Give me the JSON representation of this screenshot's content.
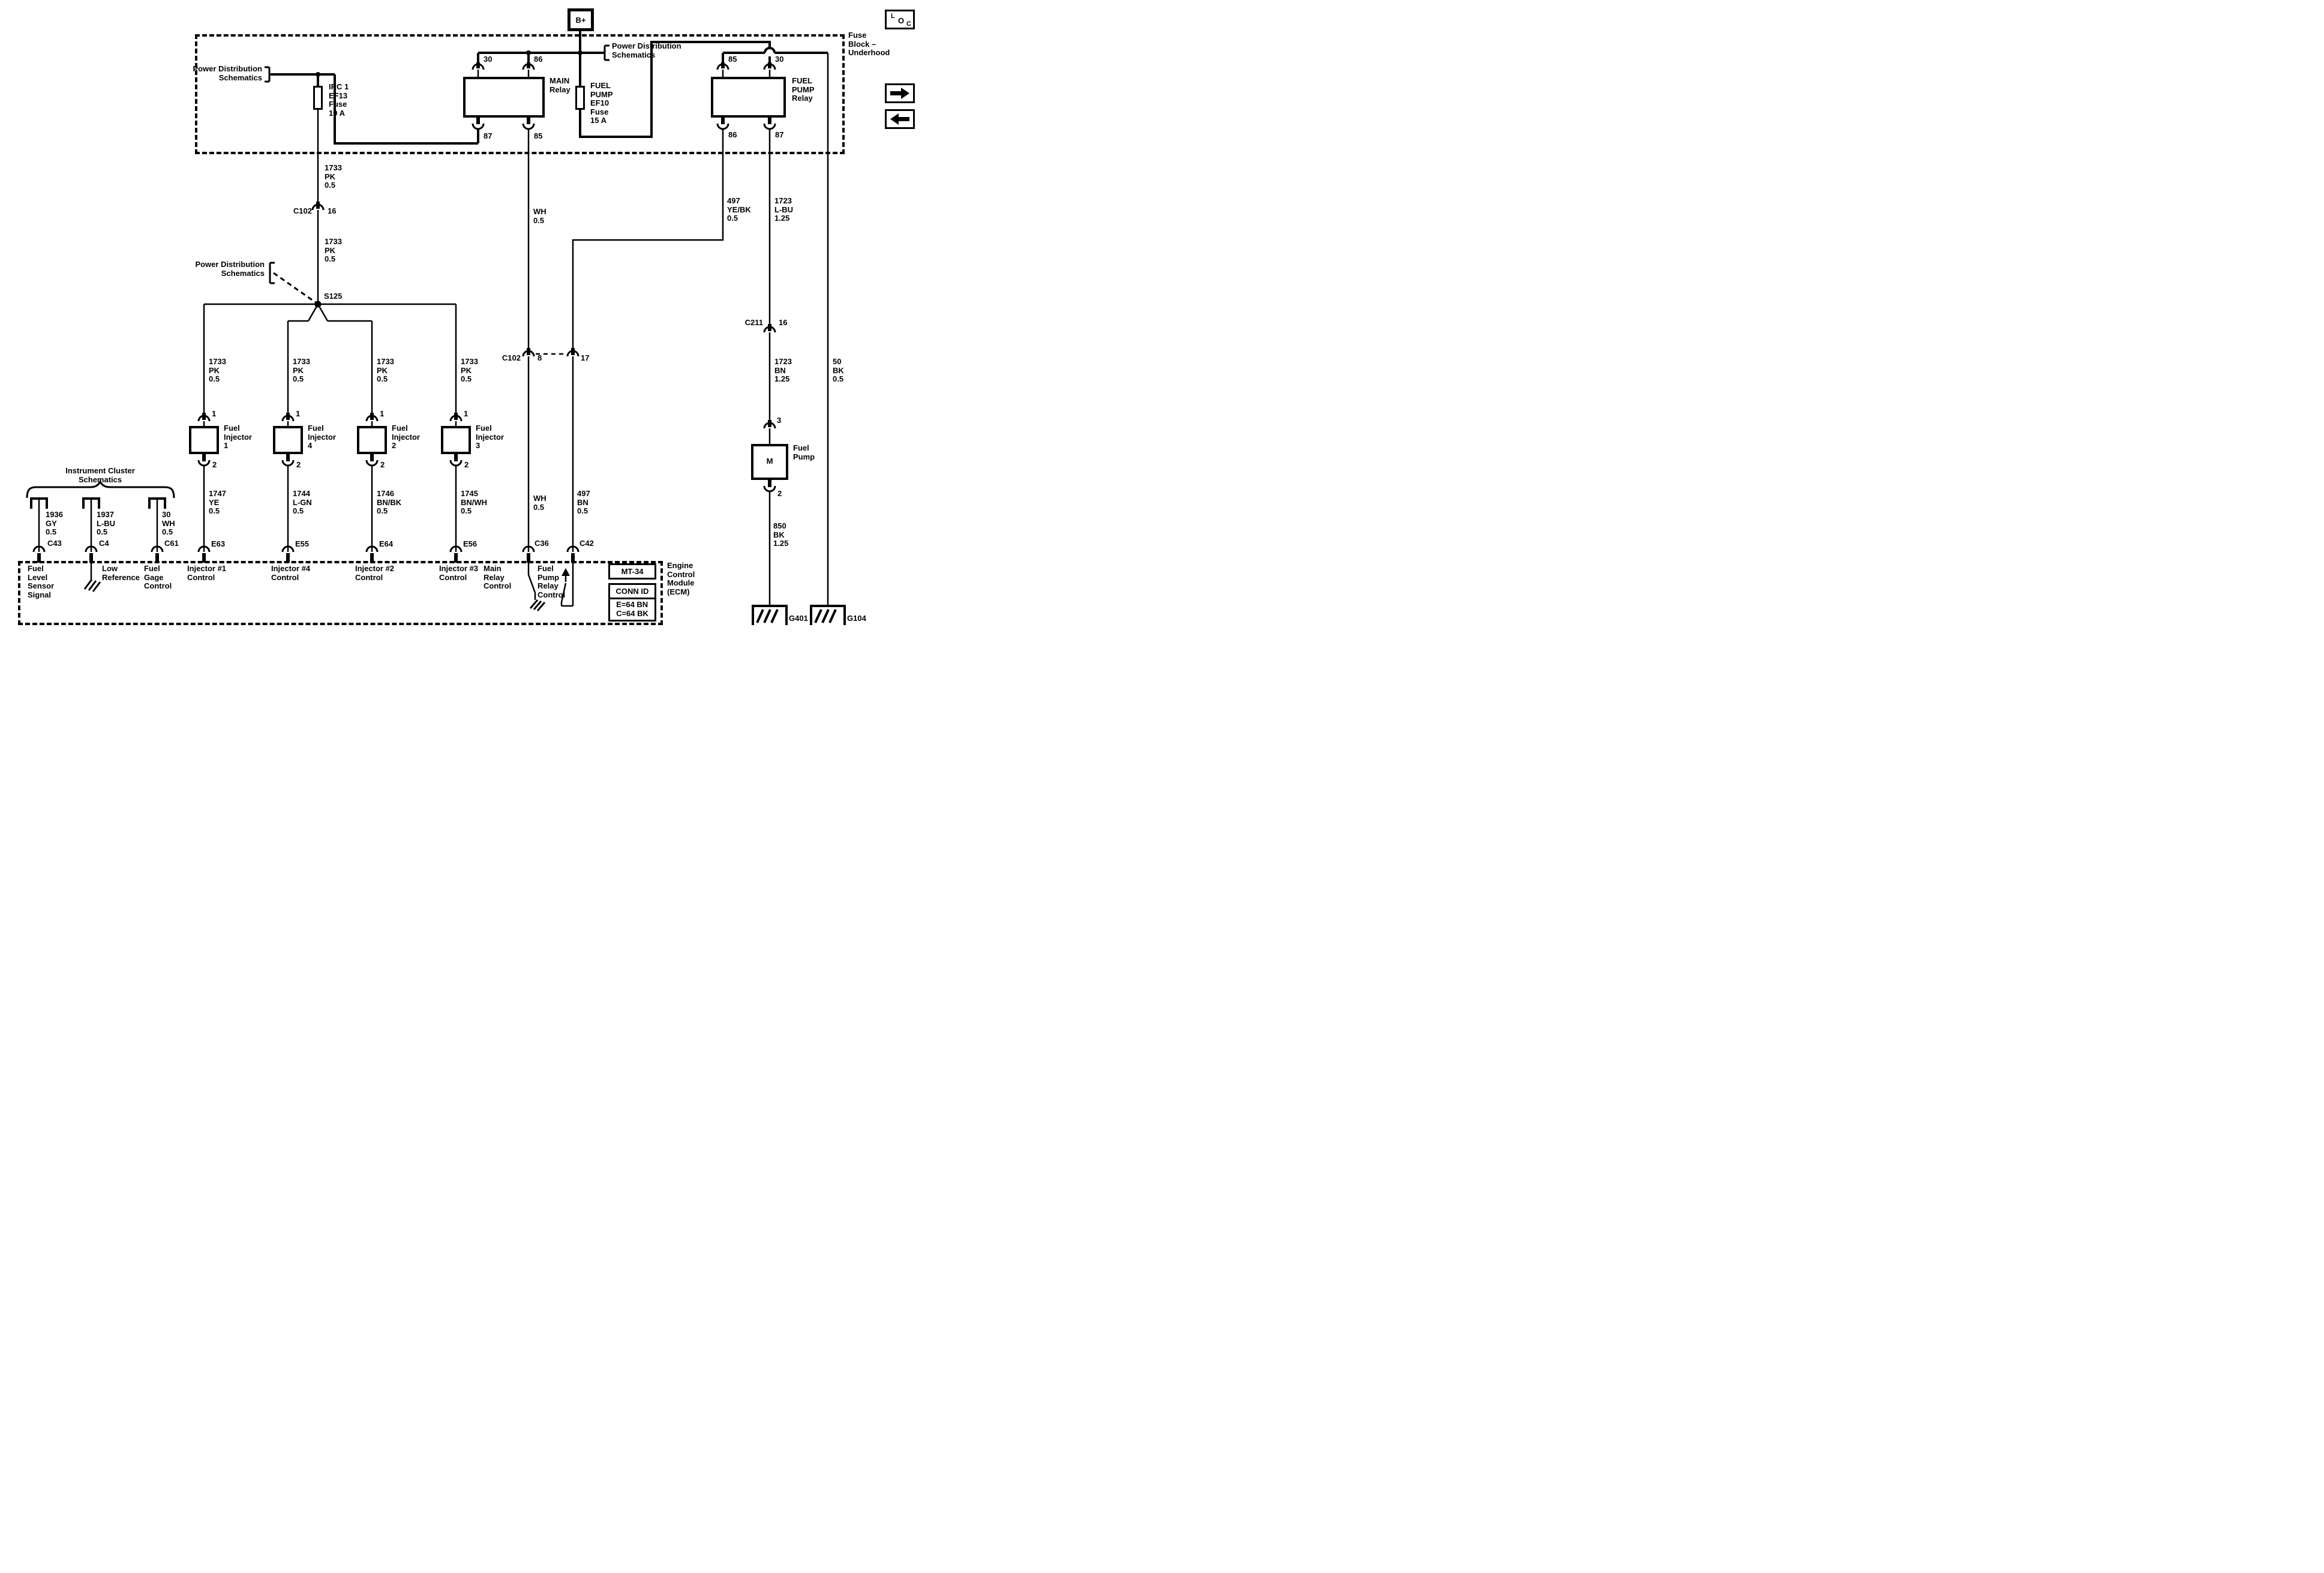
{
  "viewer": {
    "loc": {
      "l": "L",
      "o": "O",
      "c": "C"
    },
    "next_label": "next-page",
    "prev_label": "previous-page"
  },
  "fuse_block": {
    "label": "Fuse\nBlock –\nUnderhood",
    "bplus": "B+",
    "pds_top": "Power Distribution\nSchematics",
    "pds_left": "Power Distribution\nSchematics",
    "ef13_fuse": "IRC 1\nEF13\nFuse\n10 A",
    "ef10_fuse": "FUEL\nPUMP\nEF10\nFuse\n15 A",
    "main_relay": {
      "label": "MAIN\nRelay",
      "pin_30": "30",
      "pin_86": "86",
      "pin_87": "87",
      "pin_85": "85"
    },
    "fuel_pump_relay": {
      "label": "FUEL\nPUMP\nRelay",
      "pin_85": "85",
      "pin_30": "30",
      "pin_86": "86",
      "pin_87": "87"
    }
  },
  "pds_s125": "Power Distribution\nSchematics",
  "splice": "S125",
  "c102_16": {
    "name": "C102",
    "pin": "16",
    "wire_above": "1733\nPK\n0.5",
    "wire_below": "1733\nPK\n0.5"
  },
  "injectors": [
    {
      "wire_top": "1733\nPK\n0.5",
      "pin_top": "1",
      "label": "Fuel\nInjector\n1",
      "pin_bottom": "2",
      "wire_bottom": "1747\nYE\n0.5",
      "connector": "E63",
      "control": "Injector #1\nControl"
    },
    {
      "wire_top": "1733\nPK\n0.5",
      "pin_top": "1",
      "label": "Fuel\nInjector\n4",
      "pin_bottom": "2",
      "wire_bottom": "1744\nL-GN\n0.5",
      "connector": "E55",
      "control": "Injector #4\nControl"
    },
    {
      "wire_top": "1733\nPK\n0.5",
      "pin_top": "1",
      "label": "Fuel\nInjector\n2",
      "pin_bottom": "2",
      "wire_bottom": "1746\nBN/BK\n0.5",
      "connector": "E64",
      "control": "Injector #2\nControl"
    },
    {
      "wire_top": "1733\nPK\n0.5",
      "pin_top": "1",
      "label": "Fuel\nInjector\n3",
      "pin_bottom": "2",
      "wire_bottom": "1745\nBN/WH\n0.5",
      "connector": "E56",
      "control": "Injector #3\nControl"
    }
  ],
  "main_relay_branch": {
    "wire_upper": "WH\n0.5",
    "c102_name": "C102",
    "c102_pin": "8",
    "wire_lower": "WH\n0.5",
    "connector": "C36",
    "control": "Main\nRelay\nControl"
  },
  "fp_relay_branch": {
    "wire_coil": "497\nYE/BK\n0.5",
    "c102_pin": "17",
    "wire_lower": "497\nBN\n0.5",
    "connector": "C42",
    "control": "Fuel\nPump\nRelay\nControl"
  },
  "fuel_pump_circuit": {
    "wire_87": "1723\nL-BU\n1.25",
    "c211_name": "C211",
    "c211_pin": "16",
    "wire_below_c211": "1723\nBN\n1.25",
    "pump_pin_top": "3",
    "pump_label": "Fuel\nPump",
    "motor": "M",
    "pump_pin_bottom": "2",
    "wire_ground": "850\nBK\n1.25",
    "ground": "G401"
  },
  "ground_branch": {
    "wire": "50\nBK\n0.5",
    "ground": "G104"
  },
  "cluster": {
    "title": "Instrument Cluster\nSchematics",
    "branches": [
      {
        "wire": "1936\nGY\n0.5",
        "connector": "C43",
        "label": "Fuel\nLevel\nSensor\nSignal"
      },
      {
        "wire": "1937\nL-BU\n0.5",
        "connector": "C4",
        "label": "Low\nReference"
      },
      {
        "wire": "30\nWH\n0.5",
        "connector": "C61",
        "label": "Fuel\nGage\nControl"
      }
    ]
  },
  "ecm": {
    "label": "Engine\nControl\nModule\n(ECM)",
    "mt_box": "MT-34",
    "conn_id_title": "CONN ID",
    "conn_id_body": "E=64 BN\nC=64 BK"
  }
}
